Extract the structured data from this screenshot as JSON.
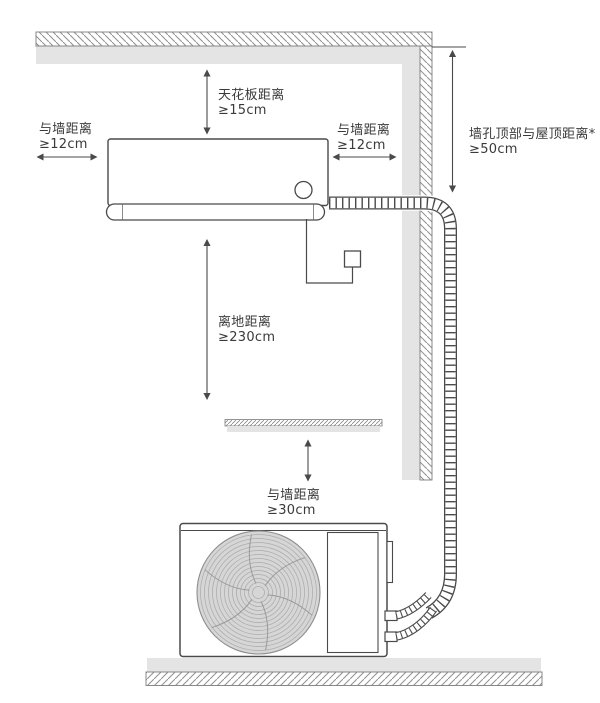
{
  "diagram": {
    "type": "air-conditioner-installation-clearance-diagram",
    "labels": {
      "ceiling_distance": {
        "name": "天花板距离",
        "value": "≥15cm"
      },
      "left_wall_distance": {
        "name": "与墙距离",
        "value": "≥12cm"
      },
      "right_wall_distance": {
        "name": "与墙距离",
        "value": "≥12cm"
      },
      "wall_hole_roof_distance": {
        "name": "墙孔顶部与屋顶距离*",
        "value": "≥50cm"
      },
      "floor_distance": {
        "name": "离地距离",
        "value": "≥230cm"
      },
      "outdoor_wall_distance": {
        "name": "与墙距离",
        "value": "≥30cm"
      }
    },
    "colors": {
      "line": "#4a4a4a",
      "text": "#3a3a3a",
      "wall_fill": "#e4e4e4",
      "hatch_line": "#909090",
      "fan_fill": "#d6d6d6"
    }
  }
}
